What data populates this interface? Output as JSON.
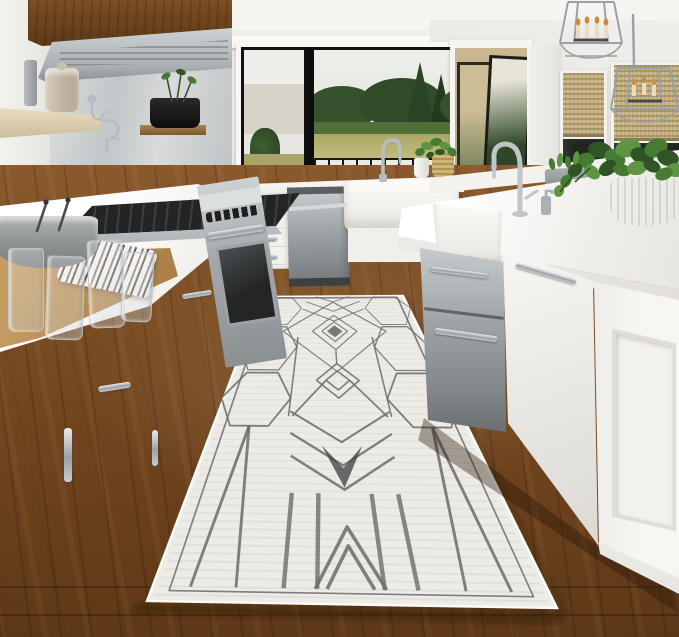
{
  "scene": {
    "type": "interior-photograph",
    "alt_text": "Bright white galley kitchen with a long ivory runner rug featuring a gray geometric hexagon, diamond and chevron pattern, laid on dark walnut hardwood flooring between white shaker cabinets with a stainless gas range on the left and a large white island with stainless drawers on the right. A black-framed picture window at the back shows evergreen trees and a sunlit field; two chrome lantern pendant lights hang at upper right over windows with woven shades.",
    "objects": [
      {
        "name": "runner-rug",
        "description": "ivory flatweave runner, gray geometric pattern: honeycomb hexagons, nested diamonds, chevrons, bottom stripes"
      },
      {
        "name": "hardwood-floor",
        "description": "medium-dark walnut plank floor"
      },
      {
        "name": "back-window",
        "description": "black-framed window, view of conifer trees, field and dark fence"
      },
      {
        "name": "range",
        "description": "stainless professional gas range with six knobs and oven"
      },
      {
        "name": "range-hood",
        "description": "stainless vent hood under wood canopy cabinet"
      },
      {
        "name": "dishwasher",
        "description": "stainless built-in dishwasher with bar handle"
      },
      {
        "name": "farmhouse-sink-back",
        "description": "white apron-front sink under window with chrome gooseneck faucet"
      },
      {
        "name": "island",
        "description": "white island: quartz top, apron sink, stainless under-counter drawers, paneled end"
      },
      {
        "name": "pendant-lights",
        "description": "two chrome lantern pendants with candle bulbs"
      },
      {
        "name": "right-windows",
        "description": "windows with woven bamboo roman shades, glass door to patio"
      },
      {
        "name": "counter-items",
        "description": "gray bowl with utensils, four drinking glasses, striped towel, wood board"
      },
      {
        "name": "plants",
        "description": "potted greens on windowsill, herb pot on shelf, large trailing pothos in ribbed white bowl"
      }
    ],
    "counts": {
      "pendants": 2,
      "glasses": 4,
      "range_knobs": 6,
      "back_drawer_pulls": 4
    }
  },
  "rug": {
    "base_color_name": "ivory",
    "pattern_color_name": "charcoal gray",
    "motifs": [
      "hexagons",
      "nested diamonds",
      "chevrons",
      "vertical stripes",
      "herringbone weave"
    ]
  },
  "palette": {
    "ceiling": "#f6f5f2",
    "wall": "#e9e7e3",
    "wall_bright": "#f3f2ef",
    "cabinet": "#f3f2ef",
    "cabinet_shadow": "#d9d6d0",
    "counter": "#f8f7f4",
    "stainless": "#b7bbbd",
    "stainless_dark": "#82888a",
    "wood_cabinet": "#7d4e22",
    "wood_cabinet_dark": "#5c3917",
    "floor": "#7a4b21",
    "floor_dark": "#57331454",
    "floor_light": "#936236",
    "rug_base": "#edebe6",
    "rug_line": "#6b6b6b",
    "rug_dark": "#474747",
    "view_sky": "#eaece7",
    "view_tree": "#344e2a",
    "view_tree_light": "#4f7039",
    "view_field": "#aaa665",
    "fence": "#171717",
    "shade": "#c2ad7d",
    "shade_dark": "#8d7c52",
    "glass_dark": "#20261f",
    "plant": "#2f5526",
    "plant_mid": "#477a33",
    "plant_light": "#5e9443",
    "chrome": "#c9ced2",
    "chrome_dark": "#8b9296",
    "candle": "#e8dcc4",
    "flame": "#c98c3f",
    "door_exterior": "#cbb691"
  }
}
